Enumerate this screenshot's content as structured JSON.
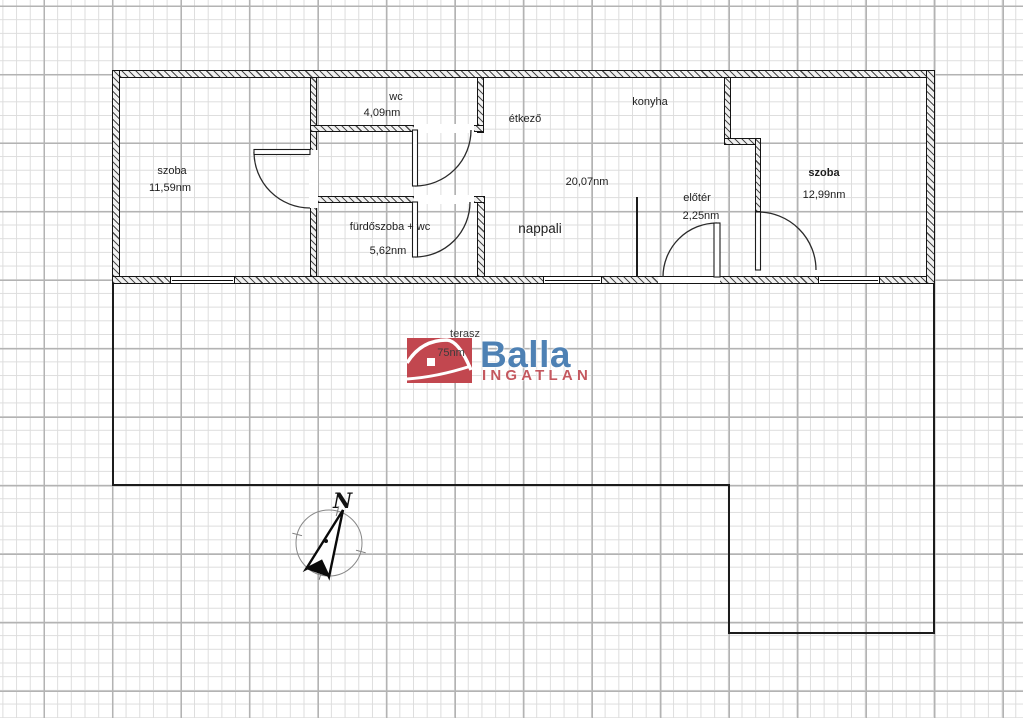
{
  "plan": {
    "rooms": [
      {
        "name": "szoba",
        "area": "11,59nm"
      },
      {
        "name": "wc",
        "area": "4,09nm"
      },
      {
        "name": "étkező"
      },
      {
        "name": "konyha"
      },
      {
        "name": "nappali",
        "area": "20,07nm"
      },
      {
        "name": "fürdőszoba + wc",
        "area": "5,62nm"
      },
      {
        "name": "előtér",
        "area": "2,25nm"
      },
      {
        "name": "szoba",
        "area": "12,99nm"
      },
      {
        "name": "terasz",
        "area": "75nm"
      }
    ],
    "compass_north_label": "N"
  },
  "logo": {
    "brand": "Balla",
    "subtitle": "INGATLAN",
    "accent_red": "#c2474f",
    "accent_blue": "#4e81b4"
  }
}
